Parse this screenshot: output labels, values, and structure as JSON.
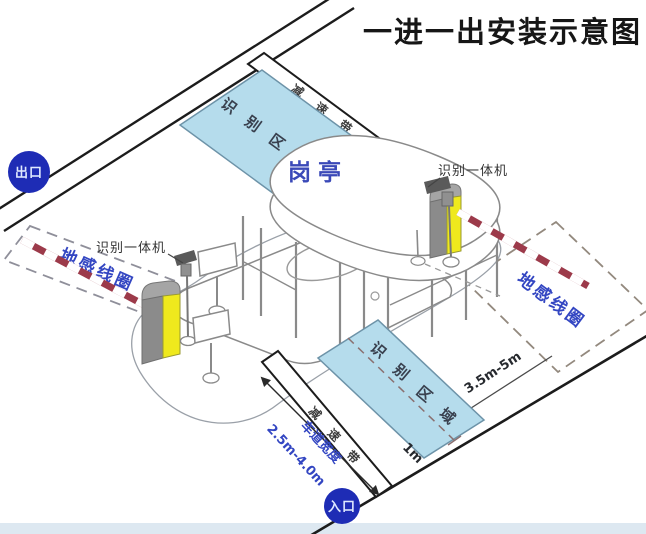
{
  "title": "一进一出安装示意图",
  "badges": {
    "exit": "出口",
    "entrance": "入口"
  },
  "booth_label": "岗亭",
  "devices": {
    "left_reader": "识别一体机",
    "right_reader": "识别一体机"
  },
  "zones": {
    "left_coil": "地感线圈",
    "right_coil": "地感线圈",
    "top_area_chars": [
      "识",
      "别",
      "区",
      "域"
    ],
    "bottom_area_chars": [
      "识",
      "别",
      "区",
      "域"
    ],
    "top_bump_chars": [
      "减",
      "速",
      "带"
    ],
    "bottom_bump_chars": [
      "减",
      "速",
      "带"
    ]
  },
  "dimensions": {
    "coil_to_area": "3.5m-5m",
    "area_offset": "1m",
    "lane_width_label": "车道宽度",
    "lane_width_value": "2.5m-4.0m"
  },
  "colors": {
    "area_fill": "#b5dcec",
    "area_stroke": "#6d93a8",
    "badge_blue": "#1e2cb5",
    "machine_yellow": "#efe91d",
    "machine_gray": "#8b8b8b",
    "arm_red": "#9c3a4a",
    "label_blue": "#3a49b8",
    "coil_text_blue": "#3346c2",
    "footer_strip": "#dde8f1"
  }
}
